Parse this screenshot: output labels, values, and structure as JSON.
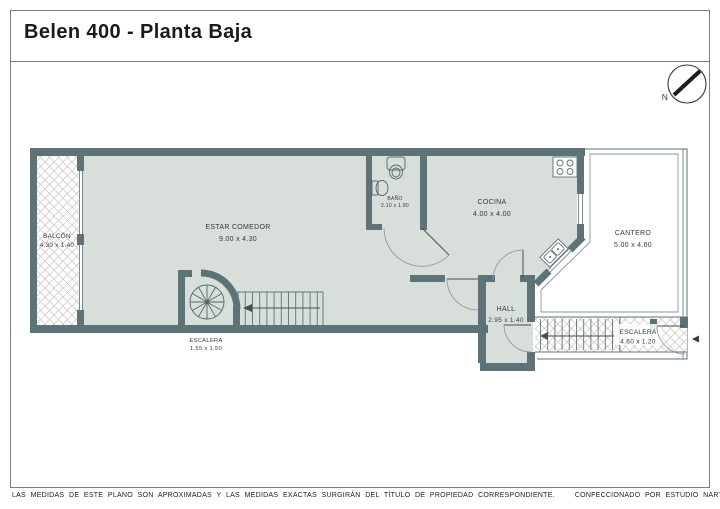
{
  "title": "Belen 400 - Planta Baja",
  "compass": {
    "label": "N"
  },
  "rooms": {
    "balcon": {
      "name": "BALCÓN",
      "dims": "4.30 x 1.40"
    },
    "estar": {
      "name": "ESTAR COMEDOR",
      "dims": "9.00 x 4.30"
    },
    "bano": {
      "name": "BAÑO",
      "dims": "2.10 x 1.80"
    },
    "cocina": {
      "name": "COCINA",
      "dims": "4.00 x 4.00"
    },
    "cantero": {
      "name": "CANTERO",
      "dims": "5.00 x 4.60"
    },
    "hall": {
      "name": "HALL",
      "dims": "2.95 x 1.40"
    },
    "escalera_interior": {
      "name": "ESCALERA",
      "dims": "1.55 x 1.50"
    },
    "escalera_exterior": {
      "name": "ESCALERA",
      "dims": "4.60 x 1.20"
    }
  },
  "footer": {
    "disclaimer": "LAS MEDIDAS DE ESTE PLANO SON APROXIMADAS Y LAS MEDIDAS EXACTAS SURGIRÁN DEL TÍTULO DE PROPIEDAD CORRESPONDIENTE.",
    "credit": "CONFECCIONADO POR ESTUDIO NARTEX"
  },
  "colors": {
    "wall": "#5e7377",
    "floor": "#d8dfdb",
    "hatch": "#c8c4bb"
  }
}
